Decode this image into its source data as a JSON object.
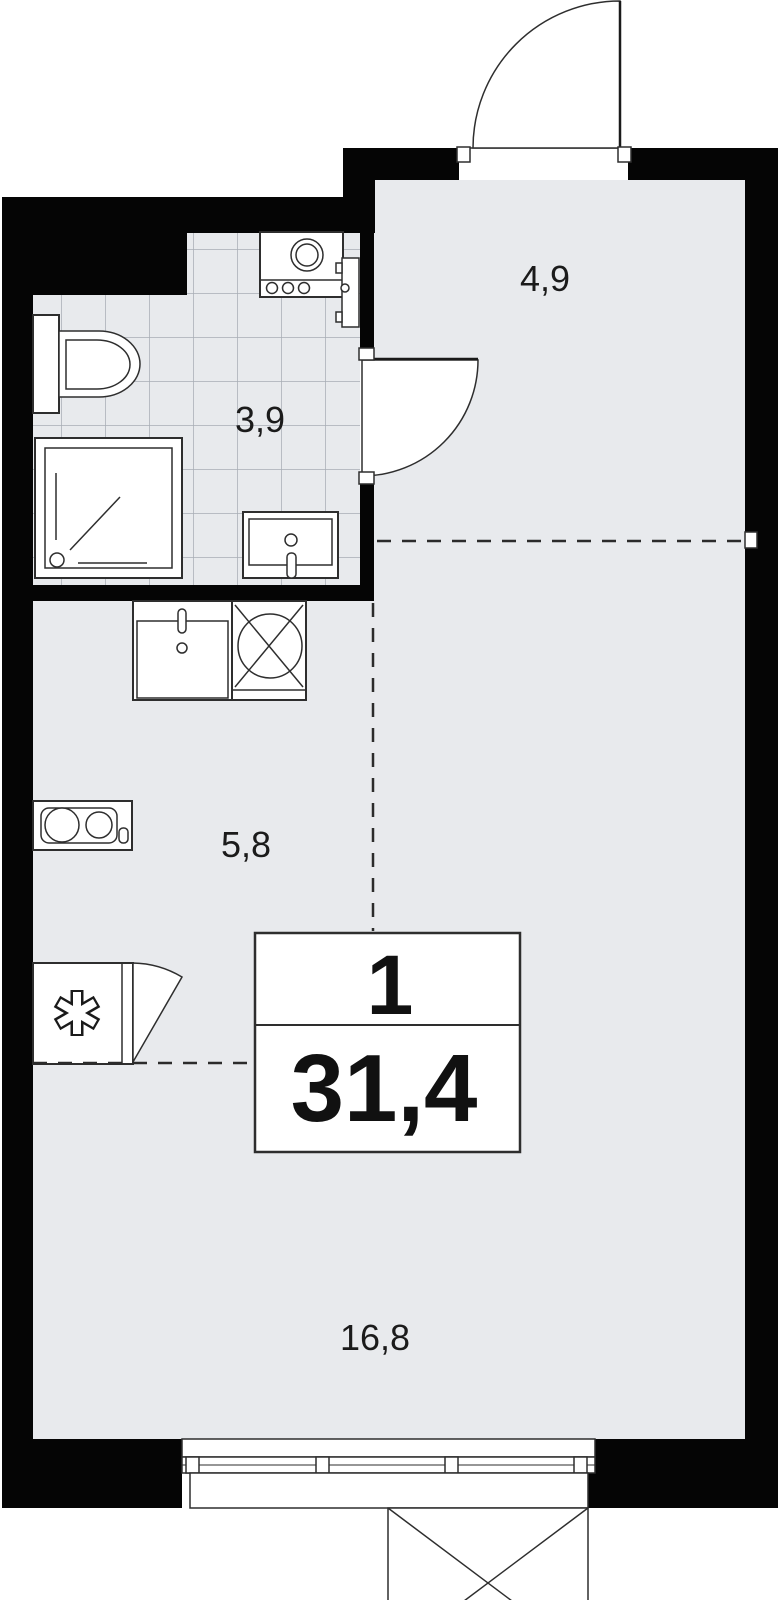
{
  "plan": {
    "title": "studio-apartment-floor-plan",
    "badge": {
      "rooms": "1",
      "area": "31,4"
    },
    "rooms": [
      {
        "name": "hall",
        "area_label": "4,9"
      },
      {
        "name": "bathroom",
        "area_label": "3,9"
      },
      {
        "name": "kitchen",
        "area_label": "5,8"
      },
      {
        "name": "living-room",
        "area_label": "16,8"
      }
    ],
    "fixtures": [
      "entrance-door",
      "bathroom-door",
      "toilet",
      "shower",
      "washing-machine",
      "bathroom-sink",
      "kitchen-sink",
      "stove",
      "cooktop",
      "fridge",
      "window",
      "balcony"
    ],
    "colors": {
      "wall": "#050505",
      "floor": "#e8eaed",
      "tile": "#a7adb5",
      "line": "#2e2e2e",
      "dash": "#2b2b2b"
    }
  }
}
